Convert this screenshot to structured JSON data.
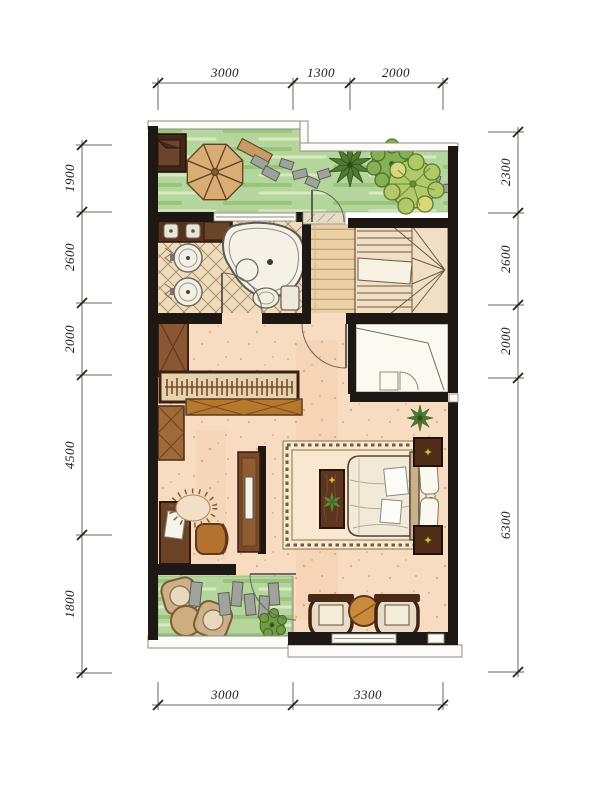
{
  "drawing": {
    "type": "residential floor plan",
    "unit_system": "millimeters"
  },
  "dimensions": {
    "top": [
      {
        "label": "3000"
      },
      {
        "label": "1300"
      },
      {
        "label": "2000"
      }
    ],
    "bottom": [
      {
        "label": "3000"
      },
      {
        "label": "3300"
      }
    ],
    "left": [
      {
        "label": "1900"
      },
      {
        "label": "2600"
      },
      {
        "label": "2000"
      },
      {
        "label": "4500"
      },
      {
        "label": "1800"
      }
    ],
    "right": [
      {
        "label": "2300"
      },
      {
        "label": "2600"
      },
      {
        "label": "2000"
      },
      {
        "label": "6300"
      }
    ]
  },
  "colors": {
    "wall": "#1d1813",
    "terrace_green": "#b4d59c",
    "bedroom_floor": "#f7dcc2",
    "wood_floor": "#ead0a6",
    "tile_base": "#eedcbe",
    "furniture_dark_wood": "#5d3520",
    "furniture_orange_wood": "#b5722f",
    "umbrella_canvas": "#d9ad74",
    "fixture_white": "#f6f1e6"
  }
}
